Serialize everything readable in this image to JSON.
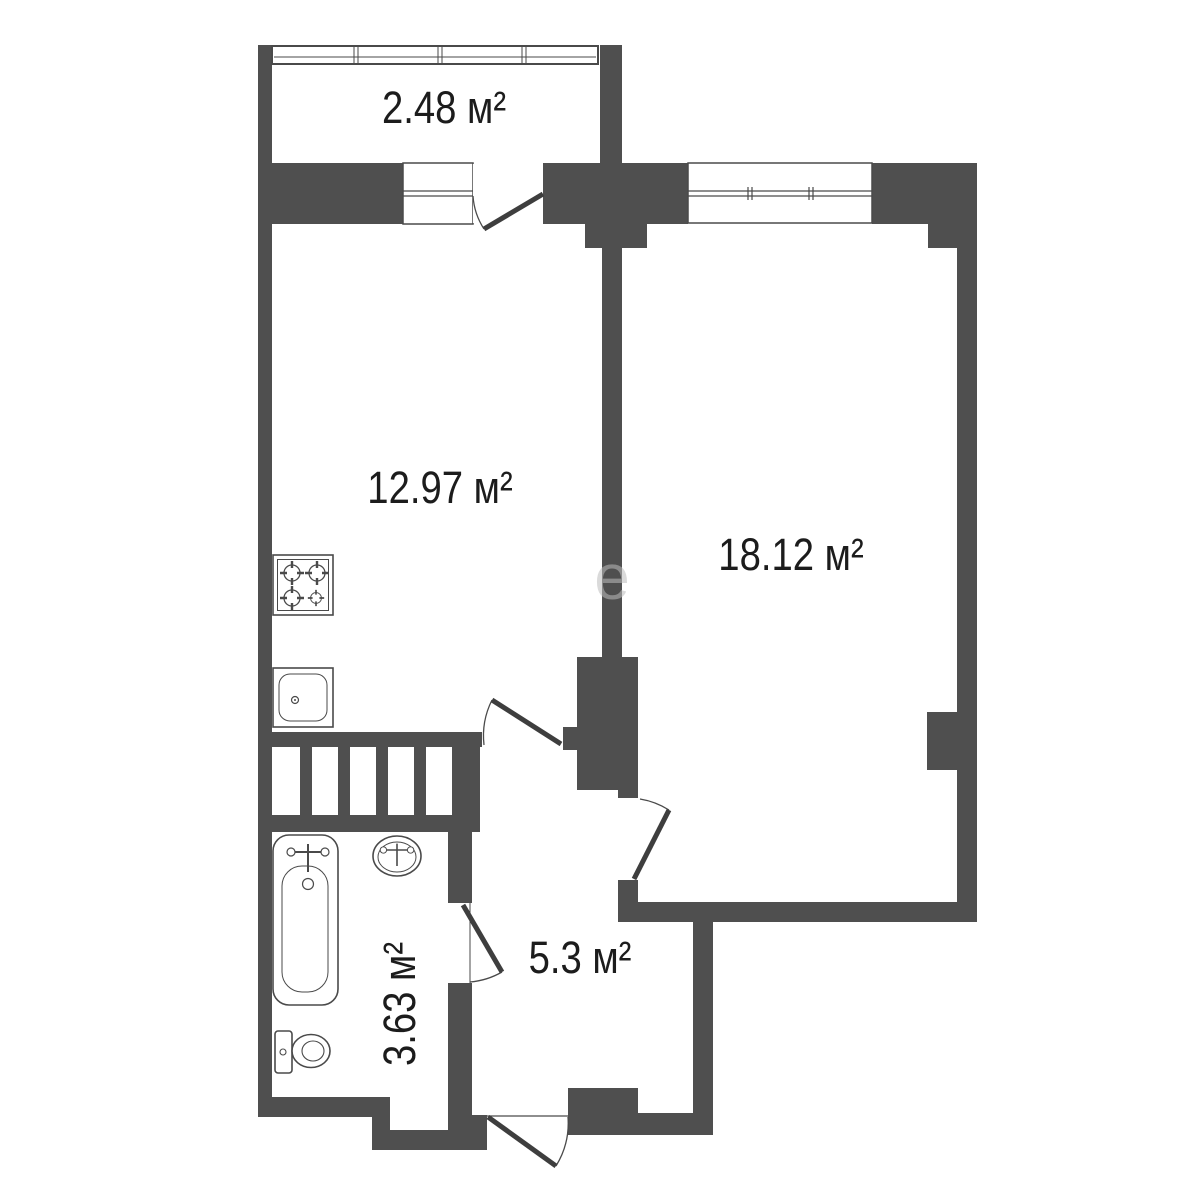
{
  "plan": {
    "background": "#ffffff",
    "wall_color": "#4f4f4f",
    "line_color": "#4a4a4a",
    "door_color": "#3e3e3e",
    "text_color": "#1c1c1c",
    "rooms": {
      "balcony": {
        "label": "2.48 м²"
      },
      "kitchen": {
        "label": "12.97 м²"
      },
      "living_room": {
        "label": "18.12 м²"
      },
      "bathroom": {
        "label": "3.63 м²"
      },
      "hallway": {
        "label": "5.3 м²"
      }
    },
    "fixtures": [
      "stove",
      "kitchen-sink",
      "bathtub",
      "washbasin",
      "toilet"
    ],
    "watermark": "е"
  }
}
